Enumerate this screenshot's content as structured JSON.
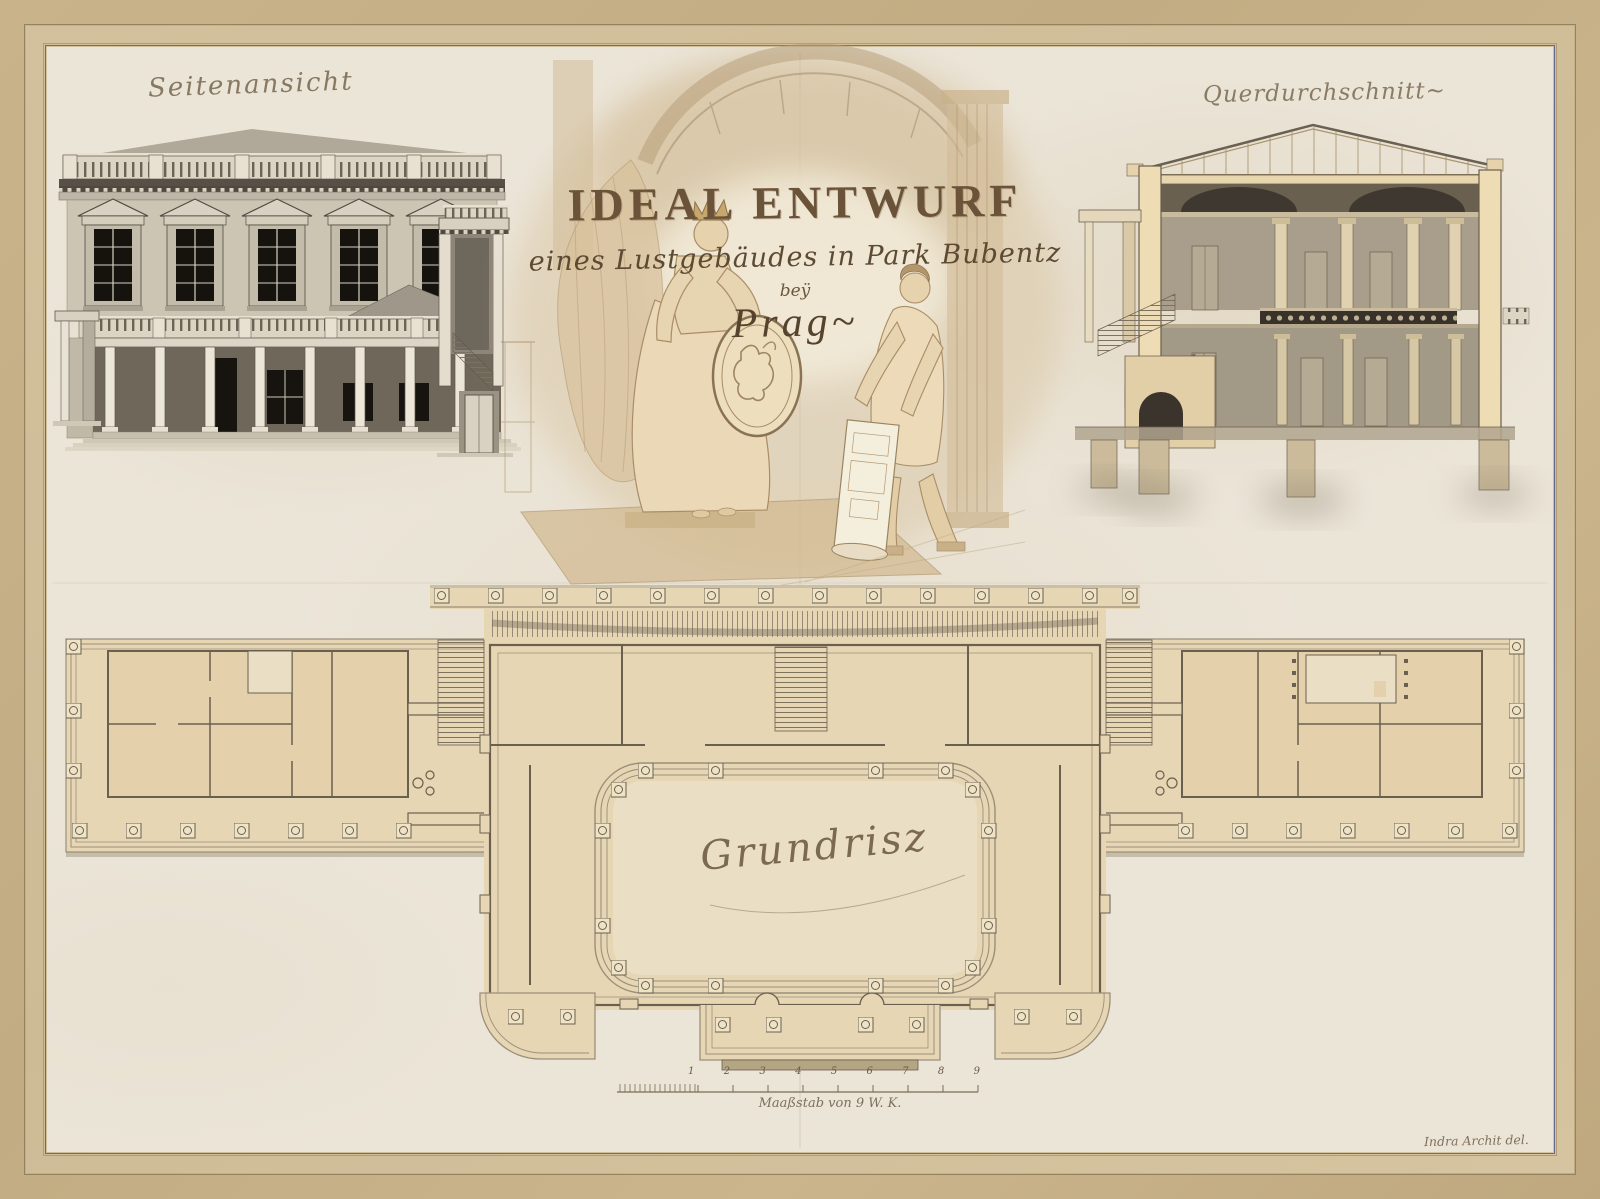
{
  "labels": {
    "side_view": "Seitenansicht",
    "cross_section": "Querdurchschnitt~",
    "floor_plan": "Grundrisz"
  },
  "title": {
    "line1": "IDEAL ENTWURF",
    "line2": "eines Lustgebäudes in Park Bubentz",
    "line3": "beÿ",
    "line4": "Prag~"
  },
  "scale_bar": {
    "numbers": [
      "1",
      "2",
      "3",
      "4",
      "5",
      "6",
      "7",
      "8",
      "9"
    ],
    "caption": "Maaßstab von 9 W. K."
  },
  "signature": "Indra Archit del.",
  "colors": {
    "mount_frame": "#c6b088",
    "paper": "#ebe5d8",
    "plan_wash": "#e7d6b4",
    "sepia_ink": "#6b5a45",
    "wall_gray": "#ccc5b4",
    "window_dark": "#16130e",
    "inner_border_blue": "#646a92"
  }
}
